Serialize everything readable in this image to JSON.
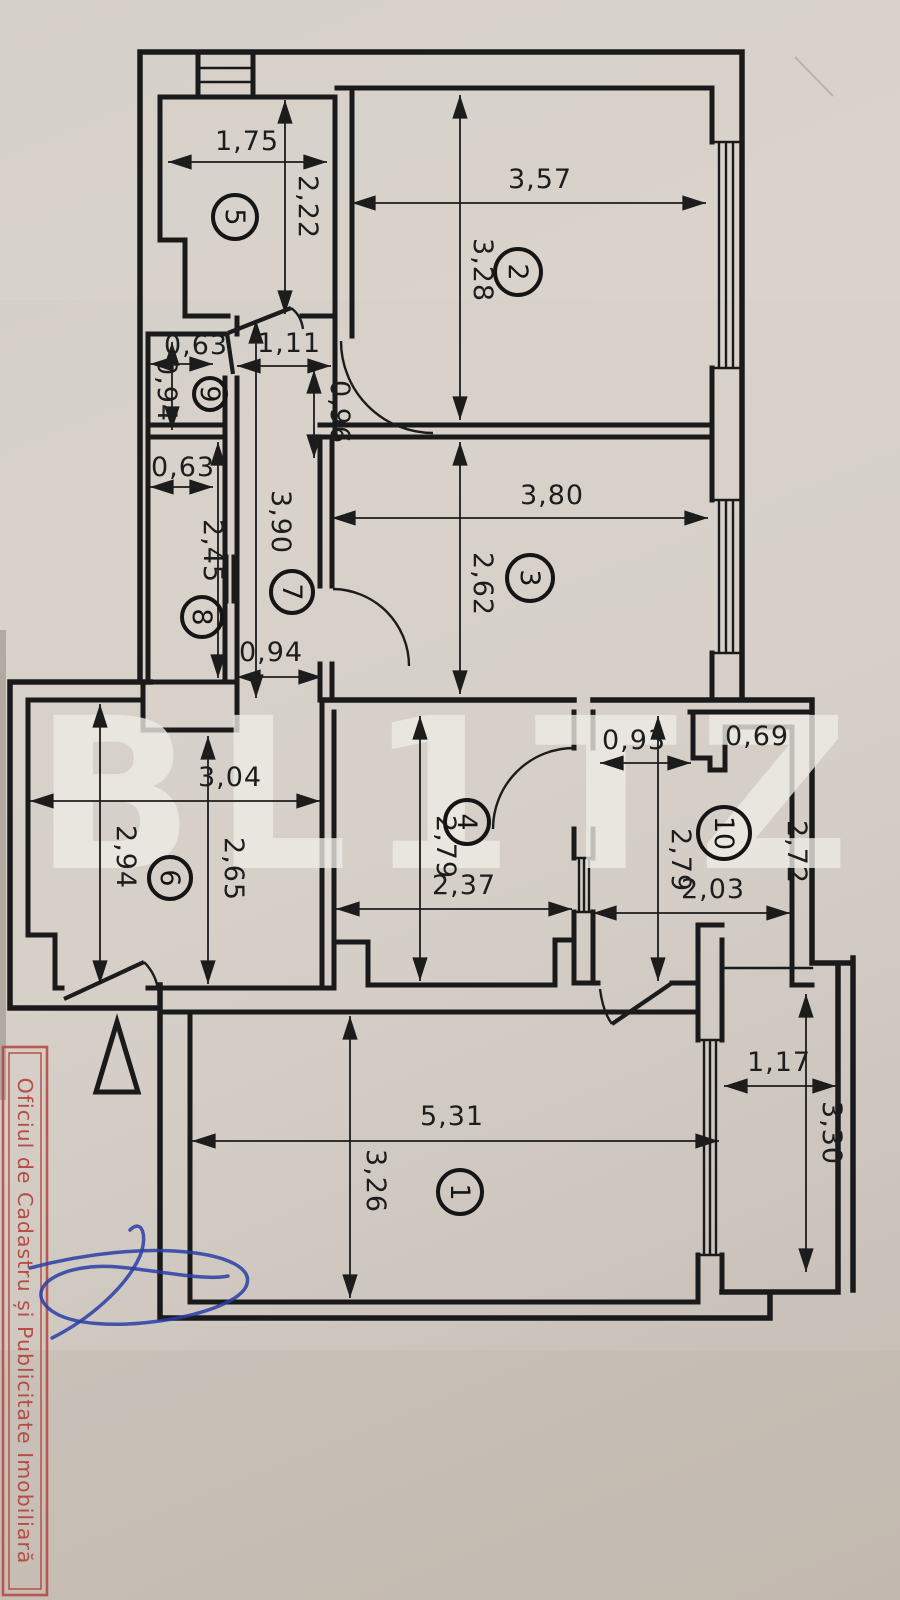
{
  "watermark": "BL1TZ",
  "stamp": "Oficiul de Cadastru și Publicitate Imobiliară",
  "rooms": {
    "r1": "1",
    "r2": "2",
    "r3": "3",
    "r4": "4",
    "r5": "5",
    "r6": "6",
    "r7": "7",
    "r8": "8",
    "r9": "9",
    "r10": "10"
  },
  "dims": {
    "r5_w": "1,75",
    "r5_h": "2,22",
    "r2_w": "3,57",
    "r2_h": "3,28",
    "r9_w": "0,63",
    "r9_h": "0,94",
    "hall_w": "1,11",
    "hall_h": "0,96",
    "r8_w": "0,63",
    "r8_h": "2,45",
    "r7_h": "3,90",
    "r7_w": "0,94",
    "r3_w": "3,80",
    "r3_h": "2,62",
    "r6_w": "3,04",
    "r6_h1": "2,94",
    "r6_h2": "2,65",
    "r4_w": "2,37",
    "r4_h": "2,79",
    "r10_d1": "0,93",
    "r10_d2": "0,69",
    "r10_h": "2,79",
    "r10_h2": "2,72",
    "r10_w": "2,03",
    "r1_w": "5,31",
    "r1_h": "3,26",
    "bal_w": "1,17",
    "bal_h": "3,30"
  }
}
